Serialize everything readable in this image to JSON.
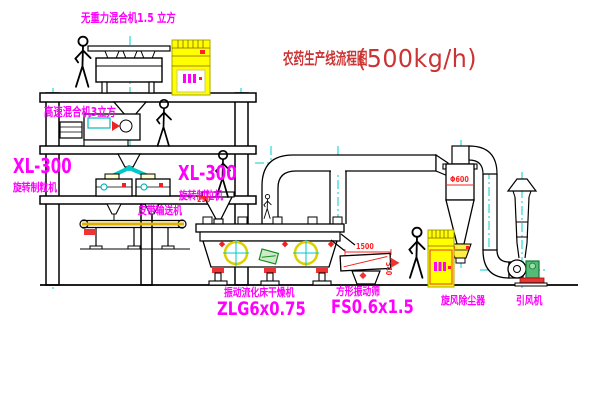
{
  "title": {
    "name": "农药生产线流程图",
    "capacity": "(500kg/h)"
  },
  "equipment_labels": {
    "gravity_free_mixer": "无重力混合机1.5 立方",
    "high_speed_mixer": "高速混合机3立方",
    "granulator_left_model": "XL-300",
    "granulator_left_name": "旋转制粒机",
    "granulator_center_model": "XL-300",
    "granulator_center_name": "旋转制粒机",
    "belt_conveyor": "皮带输送机",
    "fluid_bed_dryer_name": "振动流化床干燥机",
    "fluid_bed_dryer_model": "ZLG6x0.75",
    "square_sieve_name": "方形振动筛",
    "square_sieve_model": "FS0.6x1.5",
    "cyclone_dust_collector": "旋风除尘器",
    "induced_draft_fan": "引风机"
  },
  "dimensions": {
    "cyclone_diameter": "Φ600",
    "feeder": "250",
    "sieve_length": "1500",
    "sieve_height": "540"
  },
  "colors": {
    "label_magenta": "#ff00ff",
    "title_red": "#cc3333",
    "dimension_red": "#ff2222",
    "centerline_cyan": "#00c8c8",
    "cabinet_yellow": "#ffff00",
    "line_black": "#000000"
  }
}
